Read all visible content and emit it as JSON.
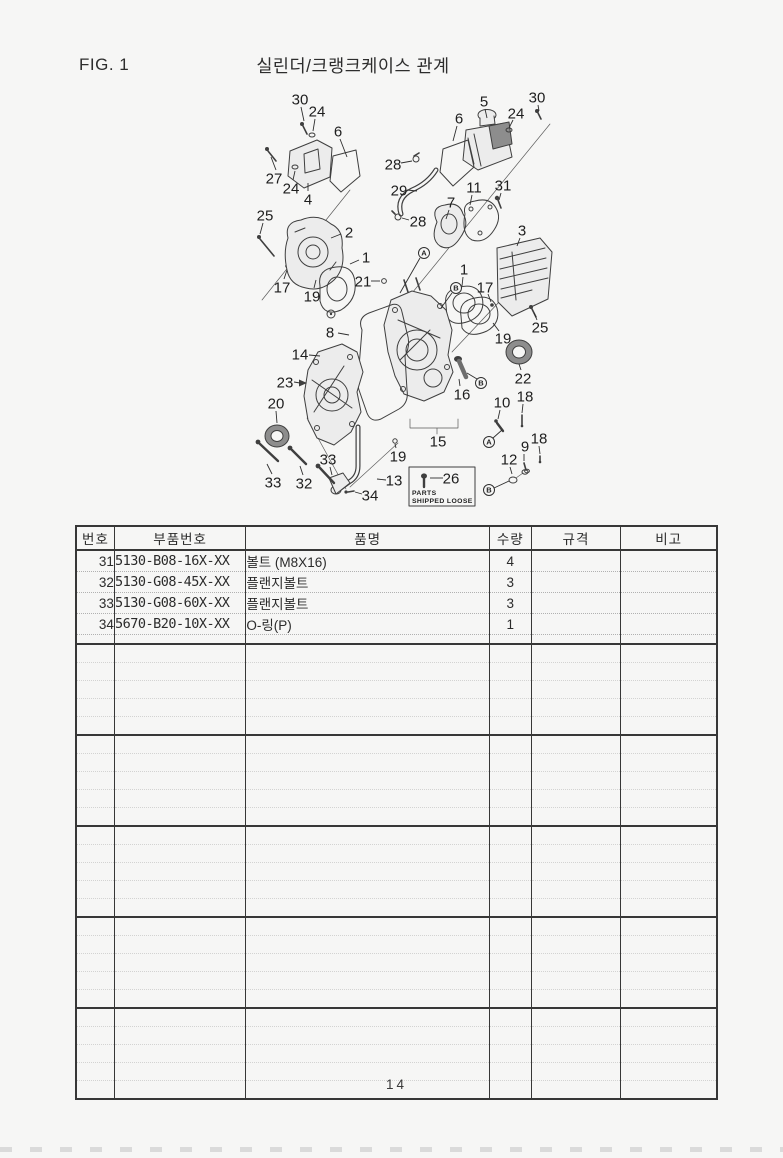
{
  "page": {
    "fig_label": "FIG. 1",
    "title": "실린더/크랭크케이스 관계",
    "page_number": "14"
  },
  "diagram": {
    "loose_parts_box": {
      "label": "26",
      "line1": "PARTS",
      "line2": "SHIPPED LOOSE"
    },
    "callouts": [
      {
        "t": "30",
        "x": 300,
        "y": 99,
        "l": [
          301,
          107,
          304,
          121
        ]
      },
      {
        "t": "24",
        "x": 317,
        "y": 111,
        "l": [
          315,
          119,
          313,
          131
        ]
      },
      {
        "t": "6",
        "x": 338,
        "y": 131,
        "l": [
          340,
          139,
          347,
          157
        ]
      },
      {
        "t": "27",
        "x": 274,
        "y": 178,
        "l": [
          276,
          170,
          271,
          157
        ]
      },
      {
        "t": "24",
        "x": 291,
        "y": 188,
        "l": [
          293,
          180,
          295,
          171
        ]
      },
      {
        "t": "4",
        "x": 308,
        "y": 199,
        "l": [
          308,
          191,
          308,
          183
        ]
      },
      {
        "t": "25",
        "x": 265,
        "y": 215,
        "l": [
          263,
          223,
          260,
          234
        ]
      },
      {
        "t": "2",
        "x": 349,
        "y": 232,
        "l": [
          341,
          234,
          331,
          238
        ]
      },
      {
        "t": "17",
        "x": 282,
        "y": 287,
        "l": [
          284,
          279,
          287,
          270
        ]
      },
      {
        "t": "19",
        "x": 312,
        "y": 296,
        "l": [
          314,
          288,
          316,
          280
        ]
      },
      {
        "t": "1",
        "x": 366,
        "y": 257,
        "l": [
          359,
          260,
          350,
          264
        ]
      },
      {
        "t": "21",
        "x": 363,
        "y": 281,
        "l": [
          371,
          281,
          380,
          281
        ]
      },
      {
        "t": "28",
        "x": 393,
        "y": 164,
        "l": [
          401,
          163,
          412,
          161
        ]
      },
      {
        "t": "29",
        "x": 399,
        "y": 190,
        "l": [
          407,
          190,
          417,
          191
        ]
      },
      {
        "t": "28",
        "x": 418,
        "y": 221,
        "l": [
          409,
          220,
          402,
          218
        ]
      },
      {
        "t": "5",
        "x": 484,
        "y": 101,
        "l": [
          485,
          109,
          487,
          118
        ]
      },
      {
        "t": "6",
        "x": 459,
        "y": 118,
        "l": [
          457,
          126,
          453,
          141
        ]
      },
      {
        "t": "24",
        "x": 516,
        "y": 113,
        "l": [
          513,
          120,
          509,
          128
        ]
      },
      {
        "t": "30",
        "x": 537,
        "y": 97,
        "l": [
          538,
          105,
          539,
          111
        ]
      },
      {
        "t": "11",
        "x": 474,
        "y": 187,
        "l": [
          472,
          195,
          470,
          205
        ]
      },
      {
        "t": "31",
        "x": 503,
        "y": 185,
        "l": [
          501,
          193,
          499,
          200
        ]
      },
      {
        "t": "7",
        "x": 451,
        "y": 202,
        "l": [
          449,
          210,
          446,
          219
        ]
      },
      {
        "t": "3",
        "x": 522,
        "y": 230,
        "l": [
          520,
          238,
          517,
          246
        ]
      },
      {
        "t": "1",
        "x": 464,
        "y": 269,
        "l": [
          463,
          277,
          462,
          286
        ]
      },
      {
        "t": "17",
        "x": 485,
        "y": 287,
        "l": [
          488,
          294,
          491,
          302
        ]
      },
      {
        "t": "19",
        "x": 503,
        "y": 338,
        "l": [
          499,
          331,
          493,
          323
        ]
      },
      {
        "t": "25",
        "x": 540,
        "y": 327,
        "l": [
          537,
          320,
          534,
          313
        ]
      },
      {
        "t": "22",
        "x": 523,
        "y": 378,
        "l": [
          521,
          370,
          519,
          364
        ]
      },
      {
        "t": "8",
        "x": 330,
        "y": 332,
        "l": [
          338,
          333,
          349,
          335
        ]
      },
      {
        "t": "14",
        "x": 300,
        "y": 354,
        "l": [
          309,
          355,
          320,
          356
        ]
      },
      {
        "t": "23",
        "x": 285,
        "y": 382,
        "l": [
          294,
          382,
          300,
          383
        ]
      },
      {
        "t": "20",
        "x": 276,
        "y": 403,
        "l": [
          276,
          411,
          277,
          423
        ]
      },
      {
        "t": "16",
        "x": 462,
        "y": 394,
        "l": [
          460,
          386,
          459,
          379
        ]
      },
      {
        "t": "15",
        "x": 438,
        "y": 441
      },
      {
        "t": "10",
        "x": 502,
        "y": 402,
        "l": [
          500,
          410,
          498,
          419
        ]
      },
      {
        "t": "18",
        "x": 525,
        "y": 396,
        "l": [
          523,
          404,
          522,
          413
        ]
      },
      {
        "t": "9",
        "x": 525,
        "y": 446,
        "l": [
          524,
          454,
          524,
          461
        ]
      },
      {
        "t": "18",
        "x": 539,
        "y": 438,
        "l": [
          539,
          446,
          540,
          454
        ]
      },
      {
        "t": "12",
        "x": 509,
        "y": 459,
        "l": [
          510,
          467,
          512,
          474
        ]
      },
      {
        "t": "19",
        "x": 398,
        "y": 456,
        "l": [
          396,
          448,
          395,
          444
        ]
      },
      {
        "t": "33",
        "x": 328,
        "y": 459,
        "l": [
          330,
          467,
          332,
          475
        ]
      },
      {
        "t": "33",
        "x": 273,
        "y": 482,
        "l": [
          272,
          474,
          267,
          464
        ]
      },
      {
        "t": "32",
        "x": 304,
        "y": 483,
        "l": [
          303,
          475,
          300,
          466
        ]
      },
      {
        "t": "34",
        "x": 370,
        "y": 495,
        "l": [
          362,
          494,
          355,
          492
        ]
      },
      {
        "t": "13",
        "x": 394,
        "y": 480,
        "l": [
          386,
          480,
          377,
          479
        ]
      },
      {
        "t": "26",
        "x": 451,
        "y": 478,
        "l": [
          430,
          478,
          443,
          478
        ]
      }
    ],
    "markers": [
      {
        "t": "A",
        "x": 424,
        "y": 253,
        "l": [
          420,
          258,
          400,
          293
        ]
      },
      {
        "t": "B",
        "x": 456,
        "y": 288,
        "l": [
          452,
          293,
          441,
          308
        ]
      },
      {
        "t": "B",
        "x": 481,
        "y": 383,
        "l": [
          477,
          379,
          467,
          373
        ]
      },
      {
        "t": "A",
        "x": 489,
        "y": 442,
        "l": [
          493,
          438,
          502,
          430
        ]
      },
      {
        "t": "B",
        "x": 489,
        "y": 490,
        "l": [
          494,
          488,
          509,
          481
        ]
      }
    ]
  },
  "parts_table": {
    "columns": [
      "번호",
      "부품번호",
      "품명",
      "수량",
      "규격",
      "비고"
    ],
    "rows": [
      {
        "no": "31",
        "part_no": "5130-B08-16X-XX",
        "name": "볼트 (M8X16)",
        "qty": "4",
        "spec": "",
        "note": ""
      },
      {
        "no": "32",
        "part_no": "5130-G08-45X-XX",
        "name": "플랜지볼트",
        "qty": "3",
        "spec": "",
        "note": ""
      },
      {
        "no": "33",
        "part_no": "5130-G08-60X-XX",
        "name": "플랜지볼트",
        "qty": "3",
        "spec": "",
        "note": ""
      },
      {
        "no": "34",
        "part_no": "5670-B20-10X-XX",
        "name": "O-링(P)",
        "qty": "1",
        "spec": "",
        "note": ""
      }
    ],
    "empty_blocks": 5,
    "rows_per_empty_block": 5
  }
}
